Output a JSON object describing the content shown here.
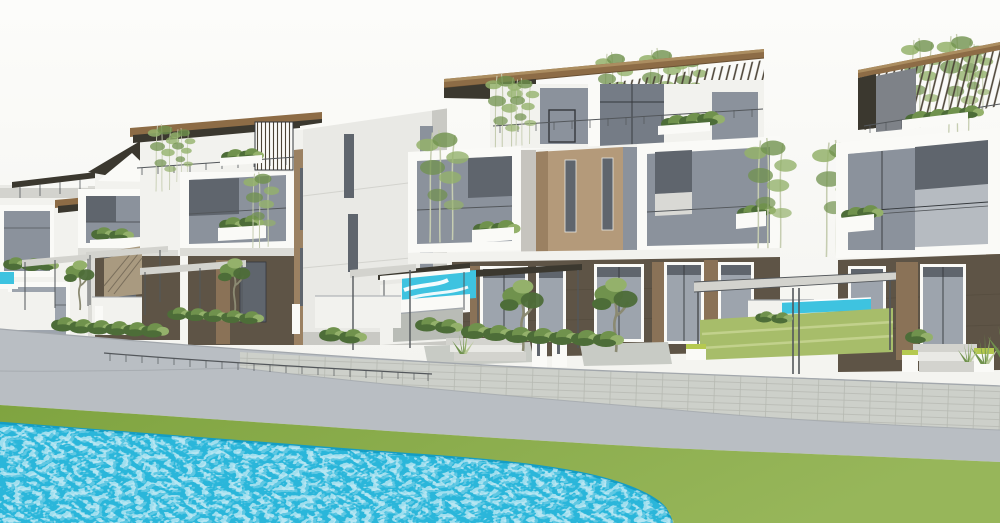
{
  "scene": {
    "type": "architectural-render",
    "description": "3D exterior rendering of a row of modern three-storey villas with slatted timber roof canopies, white frame balconies, planted terraces, front-yard pergolas, a curving promenade road and a large free-form swimming pool in the foreground"
  },
  "colors": {
    "sky_top": "#fcfcfa",
    "sky_bottom": "#f1f1ec",
    "wall_white": "#f2f2ee",
    "wall_bright": "#fafaf7",
    "wall_shade": "#dcdcd7",
    "wall_dim": "#c9c9c4",
    "concrete": "#e9e9e5",
    "concrete_dark": "#d3d3ce",
    "glass": "#8b929c",
    "glass_dark": "#5f656d",
    "glass_mid": "#757c86",
    "glass_light": "#9da4ad",
    "glass_pale": "#b6bbc1",
    "frame_dark": "#34383c",
    "roof_brown": "#8d6c46",
    "roof_highlight": "#ab8d60",
    "roof_edge": "#6a5134",
    "roof_dark": "#3b382f",
    "slat": "#4b4336",
    "tan": "#b49a7a",
    "tan_dark": "#9b8162",
    "brown_wall": "#5e5446",
    "brown_mid": "#71604f",
    "brown_light": "#8a7257",
    "plant_dark": "#4d6d38",
    "plant_mid": "#70924d",
    "plant_light": "#94b16b",
    "plant_pale": "#bac99b",
    "trunk": "#8b8a72",
    "grass_light": "#97b65a",
    "grass_deep": "#7fa440",
    "road": "#b9bec3",
    "road_edge": "#a2a7ac",
    "paver": "#cdd0ca",
    "paver_line": "#b6b9b2",
    "rail": "#53575b",
    "pool": "#2ab6da",
    "pool_deep": "#149dc4",
    "water_stripe": "#3ec3e0",
    "lime": "#b5c94f"
  }
}
